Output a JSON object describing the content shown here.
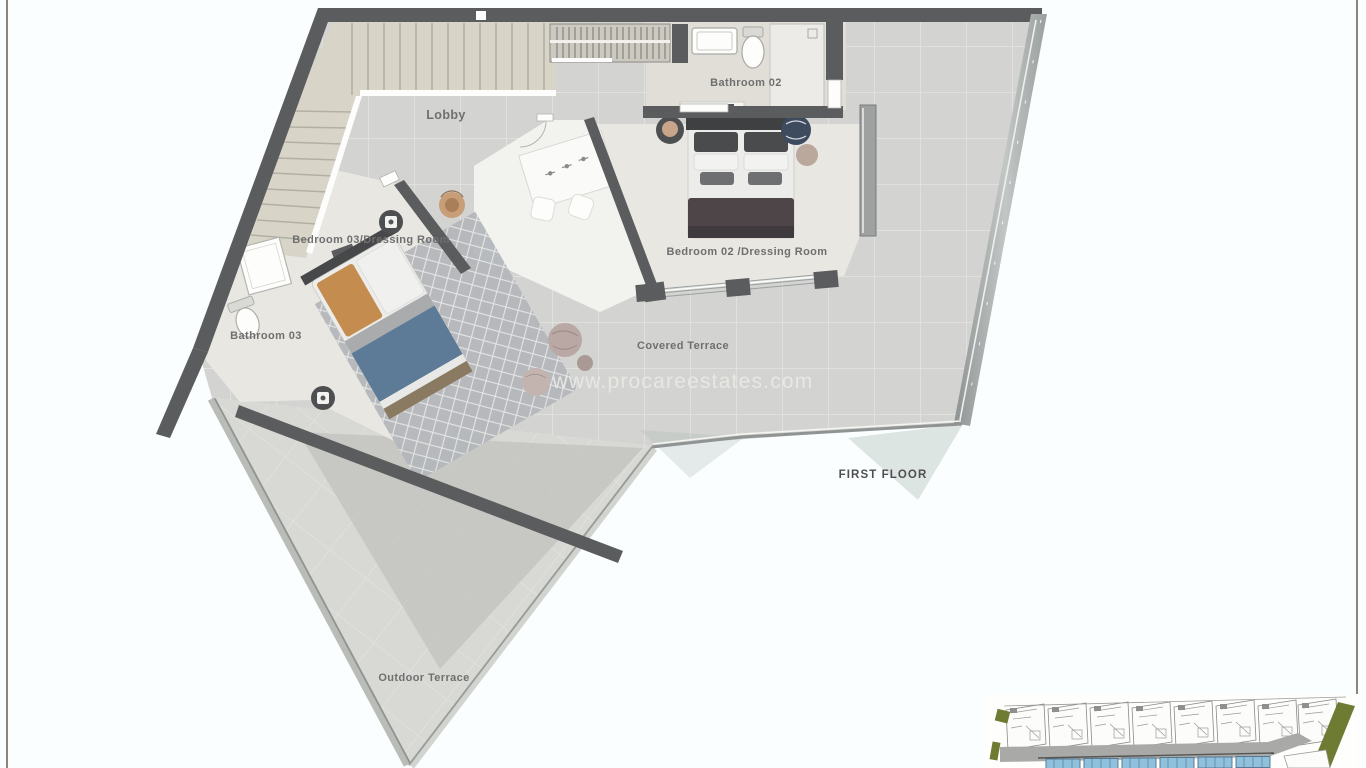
{
  "page": {
    "background": "#fbfeff",
    "border_color": "#8d8577"
  },
  "floor_plan": {
    "floor_label": "FIRST FLOOR",
    "watermark": "www.procareestates.com",
    "rooms": {
      "lobby": "Lobby",
      "bathroom_02": "Bathroom 02",
      "bedroom_02": "Bedroom 02 /Dressing Room",
      "bedroom_03": "Bedroom 03/Dressing Room",
      "bathroom_03": "Bathroom 03",
      "covered_terrace": "Covered Terrace",
      "outdoor_terrace": "Outdoor Terrace"
    },
    "colors": {
      "wall": "#5b5c5e",
      "floor_tile": "#d3d3d1",
      "grout": "#e7e7e4",
      "light_floor": "#e8e7e2",
      "bath_floor": "#e0ded7",
      "stairs": "#d8d4c8",
      "stair_tread": "#b3afa3",
      "white_area": "#f2f2ef",
      "rug": "#b4b7bb",
      "bed_blanket_blue": "#5d7a96",
      "bed_pillow_orange": "#c48d4f",
      "bed_blanket_dark": "#4e4549",
      "bed_white": "#ecedeb",
      "glass": "#9fa6a5",
      "curb": "#b9bcb7",
      "shadow": "#c1c1bd",
      "plant_pot": "#4e4f51",
      "plant_leaf": "#c9a58a",
      "pouf_pink": "#b9a8a4",
      "label_text": "#6f6f6f",
      "watermark_text": "#e9e9e5"
    }
  },
  "site_plan_inset": {
    "colors": {
      "road": "#a9a9a7",
      "pool_blue": "#8fc1dd",
      "pool_frame": "#4f6f8c",
      "landscape_green": "#6e7c33",
      "plan_lines": "#8a8a88"
    }
  }
}
